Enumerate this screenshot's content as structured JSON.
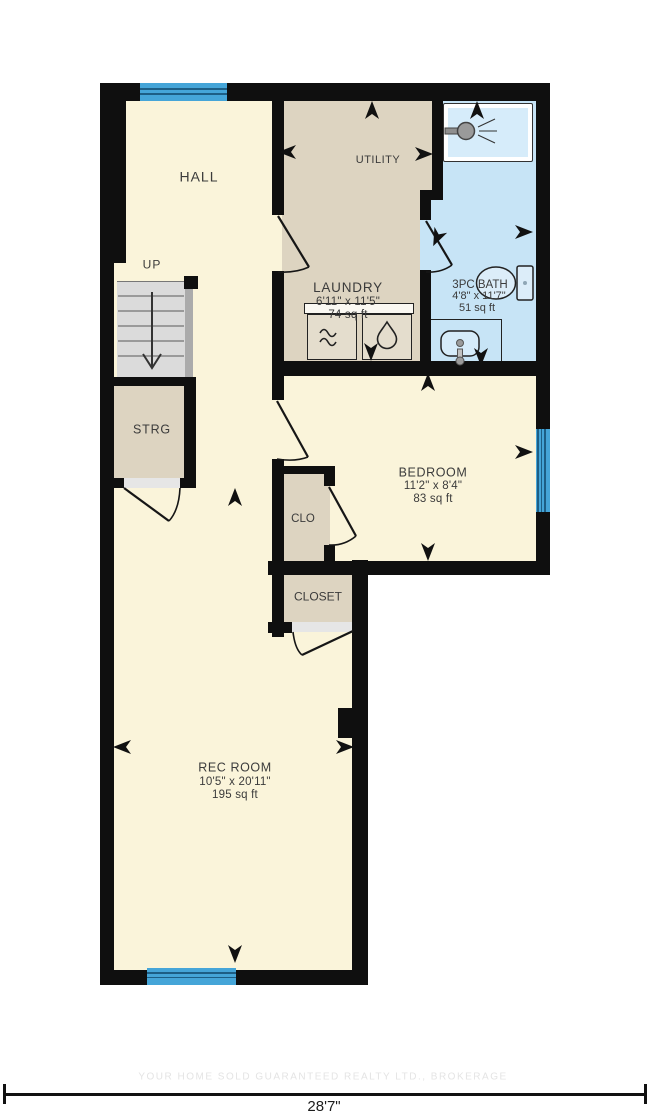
{
  "floorplan": {
    "rooms": {
      "hall": {
        "name": "HALL"
      },
      "stairs": {
        "name": "UP"
      },
      "utility": {
        "name": "UTILITY"
      },
      "laundry": {
        "name": "LAUNDRY",
        "dims": "6'11\" x 11'5\"",
        "area": "74 sq ft"
      },
      "bath": {
        "name": "3PC BATH",
        "dims": "4'8\" x 11'7\"",
        "area": "51 sq ft"
      },
      "bedroom": {
        "name": "BEDROOM",
        "dims": "11'2\" x 8'4\"",
        "area": "83 sq ft"
      },
      "clo": {
        "name": "CLO"
      },
      "closet": {
        "name": "CLOSET"
      },
      "strg": {
        "name": "STRG"
      },
      "rec_room": {
        "name": "REC ROOM",
        "dims": "10'5\" x 20'11\"",
        "area": "195 sq ft"
      }
    },
    "dimension": {
      "overall_width": "28'7\""
    },
    "watermark": "YOUR HOME SOLD GUARANTEED REALTY LTD., BROKERAGE",
    "icons": {
      "shower": "shower-head-icon",
      "toilet": "toilet-icon",
      "sink": "sink-icon",
      "washer": "washer-icon",
      "dryer": "dryer-icon",
      "stairs": "stairs-down-arrow-icon"
    },
    "colors": {
      "floor_cream": "#faf4da",
      "floor_tan": "#ddd4c1",
      "floor_bath": "#c7e4f6",
      "window_blue": "#45a5d8",
      "wall_black": "#0f0f0f",
      "stairs_gray": "#dbdbdb"
    }
  }
}
